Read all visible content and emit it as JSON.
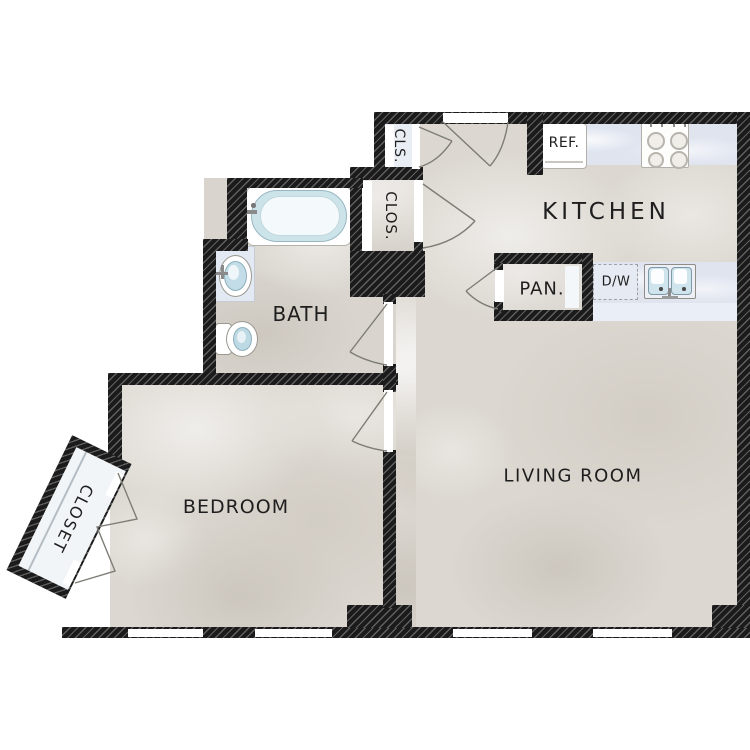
{
  "rooms": {
    "kitchen": {
      "label": "KITCHEN"
    },
    "living_room": {
      "label": "LIVING ROOM"
    },
    "bedroom": {
      "label": "BEDROOM"
    },
    "bath": {
      "label": "BATH"
    },
    "pantry": {
      "label": "PAN."
    },
    "hall_closet_small": {
      "label": "CLS."
    },
    "hall_closet": {
      "label": "CLOS."
    },
    "bedroom_closet": {
      "label": "CLOSET"
    }
  },
  "appliances": {
    "refrigerator": {
      "label": "REF."
    },
    "dishwasher": {
      "label": "D/W"
    }
  },
  "fixtures": [
    "bathtub-icon",
    "bathroom-sink-icon",
    "toilet-icon",
    "stove-icon",
    "kitchen-sink-icon",
    "door-swing-icon",
    "bifold-door-icon",
    "window-icon"
  ],
  "colors": {
    "wall": "#1b1b1b",
    "floor": "#dcd8d1",
    "counter": "#dfe4ef",
    "fixture_blue": "#cde3ec",
    "background": "#ffffff"
  }
}
